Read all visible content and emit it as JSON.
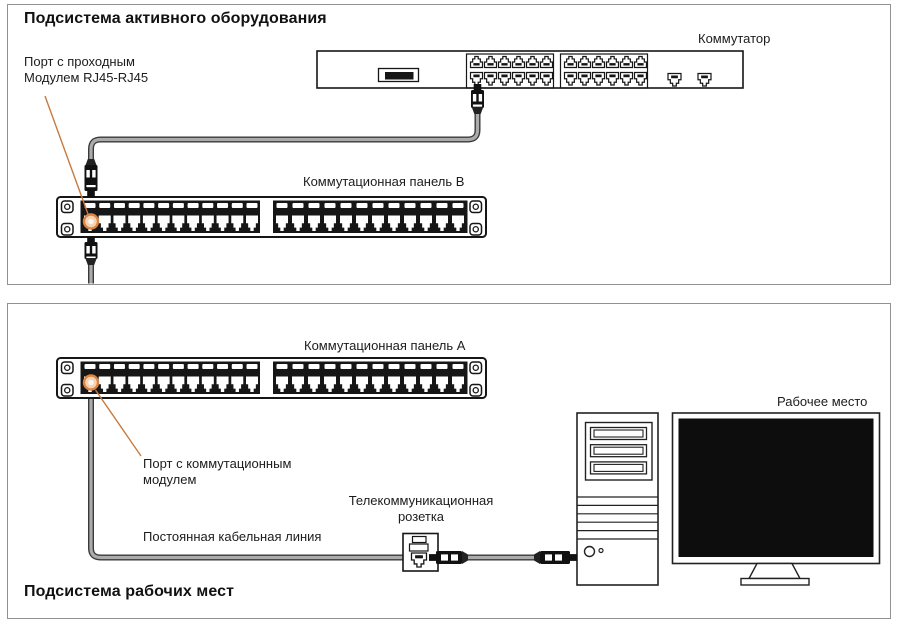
{
  "sections": {
    "active_equipment": {
      "title": "Подсистема активного оборудования"
    },
    "workplaces": {
      "title": "Подсистема рабочих мест"
    }
  },
  "labels": {
    "switch": "Коммутатор",
    "patch_panel_b": "Коммутационная панель B",
    "patch_panel_a": "Коммутационная панель A",
    "passthrough_port_lines": [
      "Порт с проходным",
      "Модулем RJ45-RJ45"
    ],
    "patch_module_port_lines": [
      "Порт с коммутационным",
      "модулем"
    ],
    "telecom_outlet_lines": [
      "Телекоммуникационная",
      "розетка"
    ],
    "permanent_link": "Постоянная кабельная линия",
    "workplace": "Рабочее место"
  },
  "devices": {
    "switch": {
      "port_groups": 2,
      "ports_per_group": 12,
      "port_rows": 2,
      "uplink_ports": 2
    },
    "patch_panel_b": {
      "port_groups": 2,
      "ports_per_group": 12,
      "highlighted_port": 1
    },
    "patch_panel_a": {
      "port_groups": 2,
      "ports_per_group": 12,
      "highlighted_port": 1
    },
    "telecom_outlet": {
      "ports": 1
    },
    "workstation": {
      "components": [
        "system-unit",
        "monitor"
      ]
    }
  },
  "colors": {
    "ink": "#161616",
    "accent_orange": "#dd8441",
    "accent_orange_fill": "#f4d2b4",
    "leader_orange": "#c87a3e",
    "cable_edge": "#3a3a3a",
    "cable_core": "#ababab",
    "plug_black": "#111111",
    "screen_black": "#0d0d0d",
    "section_border": "#929292"
  }
}
